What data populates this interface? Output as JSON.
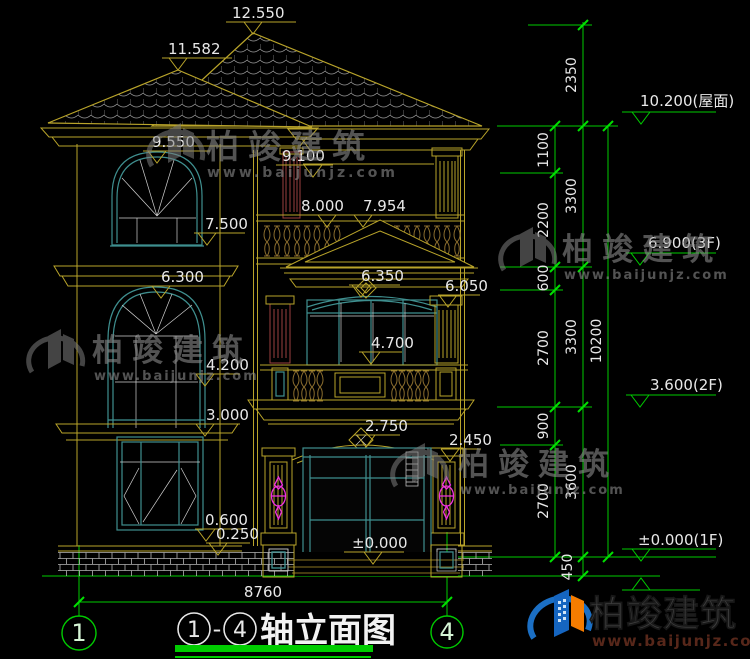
{
  "drawing": {
    "title": {
      "axis_start": "1",
      "dash": "-",
      "axis_end": "4",
      "name": "轴立面图"
    },
    "axes": {
      "left": "1",
      "right": "4"
    },
    "overall_width": "8760"
  },
  "elevation_labels": [
    "12.550",
    "11.582",
    "9.550",
    "9.100",
    "8.000",
    "7.954",
    "7.500",
    "6.300",
    "6.350",
    "6.050",
    "4.700",
    "4.200",
    "3.000",
    "2.750",
    "2.450",
    "0.600",
    "0.250",
    "±0.000"
  ],
  "level_labels": [
    "10.200(屋面)",
    "6.900(3F)",
    "3.600(2F)",
    "±0.000(1F)"
  ],
  "dim_chains": {
    "inner": [
      "1100",
      "2200",
      "600",
      "2700",
      "900",
      "2700"
    ],
    "middle": [
      "2350",
      "3300",
      "3300",
      "3600",
      "450"
    ],
    "outer": [
      "10200"
    ]
  },
  "watermark": {
    "brand": "柏竣建筑",
    "url": "www.baijunjz.com"
  },
  "footer": {
    "brand": "柏竣建筑",
    "url": "www.baijunjz.com"
  },
  "colors": {
    "dim_green": "#00cc00",
    "line_yellow": "#b9a42a",
    "line_dark_yellow": "#8a7420",
    "window_teal": "#3f8f8f",
    "lamp_magenta": "#f030e0",
    "pilaster_red": "#9b4040",
    "logo_blue": "#1565c0",
    "logo_orange": "#f57c00",
    "tile_gray": "#9a9a9a"
  }
}
